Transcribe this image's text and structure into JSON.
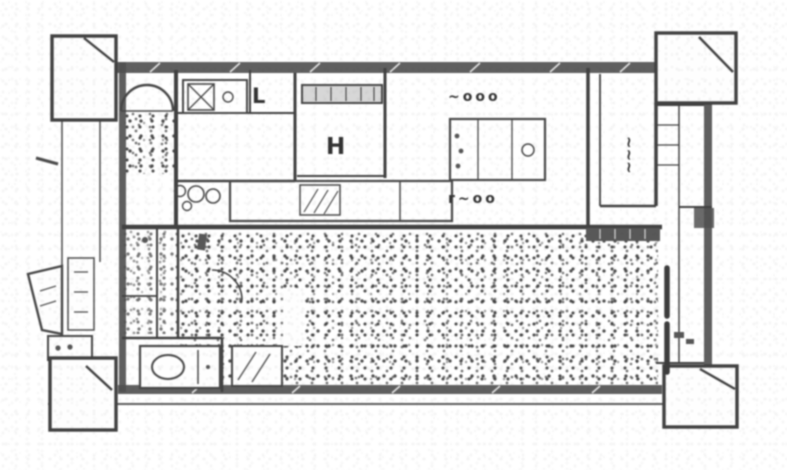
{
  "colors": {
    "background": "#ffffff",
    "line": "#3e3e3e",
    "wall_fill": "#4f4f4f",
    "speckle": "#5a5a5a",
    "text": "#2f2f2f"
  },
  "labels": {
    "entry_glyph_l": "L",
    "bath_glyph_h": "H",
    "kitchen_strip_top": "~ooo",
    "kitchen_strip_bottom": "r~oo",
    "right_room_vertical": "~~~"
  }
}
